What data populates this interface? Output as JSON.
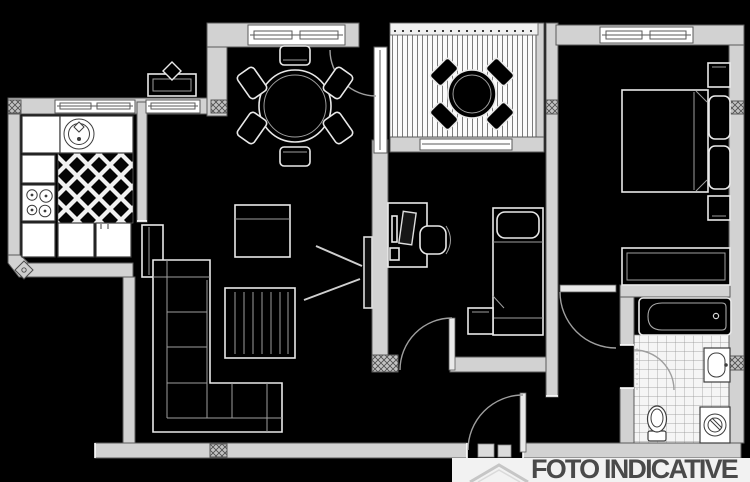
{
  "image": {
    "width": 750,
    "height": 482,
    "kind": "apartment-floor-plan"
  },
  "watermark": {
    "text": "FOTO INDICATIVE",
    "color": "#4a4a4a",
    "icon": "house-roof-icon"
  },
  "palette": {
    "background": "#000000",
    "wall_fill": "#d2d2d2",
    "wall_stroke": "#5a5a5a",
    "line_light": "#e9e9e9",
    "line_mid": "#9e9e9e",
    "fixture_stroke": "#3c3c3c",
    "white": "#ffffff",
    "text_gray": "#4a4a4a",
    "card_bg": "#f2f2f2",
    "watermark_gray": "#c6c6c6"
  },
  "plan": {
    "rooms": [
      {
        "name": "kitchen",
        "floor": "diagonal-lattice-tile"
      },
      {
        "name": "living-dining-room",
        "floor": "plain"
      },
      {
        "name": "terrace",
        "floor": "striped-decking"
      },
      {
        "name": "bedroom",
        "floor": "plain"
      },
      {
        "name": "study-bedroom",
        "floor": "plain"
      },
      {
        "name": "hallway",
        "floor": "plain"
      },
      {
        "name": "bathroom",
        "floor": "grid-tile"
      }
    ],
    "furniture": [
      "kitchen-sink",
      "stove-4-burners",
      "fridge",
      "kitchen-counters",
      "round-dining-table-6-chairs",
      "l-shaped-sofa",
      "coffee-table",
      "rug",
      "wall-tv",
      "cabinet",
      "terrace-round-table-4-chairs",
      "terrace-railing",
      "double-bed",
      "pillows",
      "nightstands",
      "wardrobe",
      "desk",
      "computer-monitor",
      "office-chair",
      "single-bed",
      "small-nightstand",
      "bathtub",
      "washbasin",
      "toilet",
      "washing-machine",
      "entry-door",
      "room-doors",
      "windows",
      "radiator-box",
      "column-ornament"
    ]
  }
}
